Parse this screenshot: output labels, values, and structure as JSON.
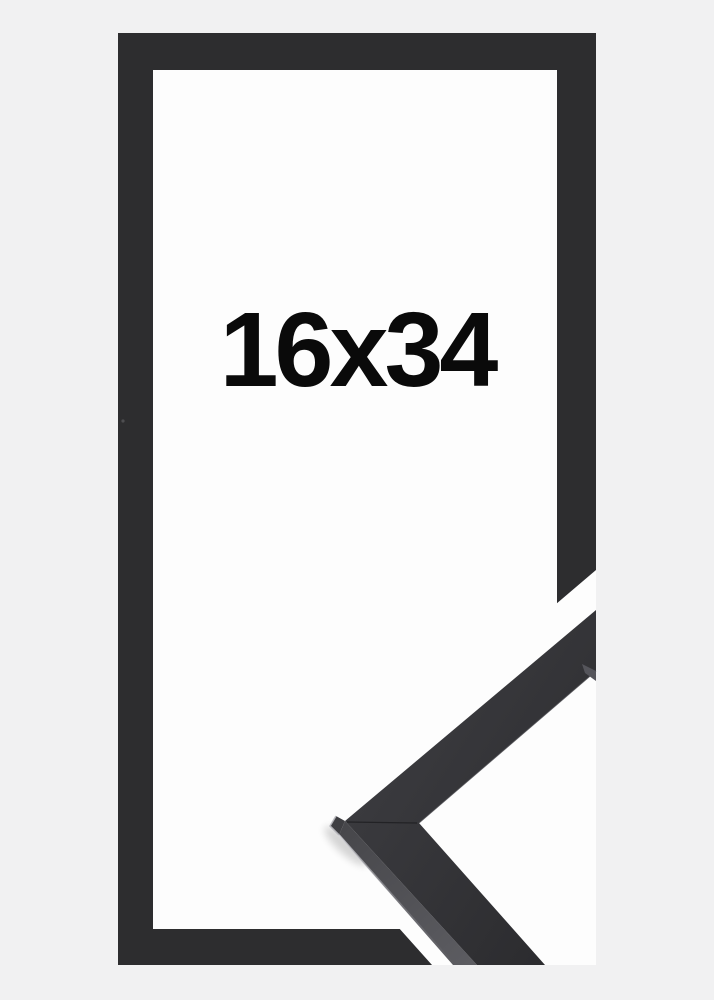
{
  "product": {
    "size_label": "16x34"
  },
  "colors": {
    "background": "#f1f1f2",
    "frame": "#2d2d2f",
    "interior_white": "#fdfdfd",
    "halo_white": "#fdfdfd",
    "label_text": "#0a0a0a",
    "moulding_top_light": "#38383c",
    "moulding_top_dark": "#2b2b2e",
    "moulding_side": "#515156",
    "moulding_end_face": "#55555b",
    "seam": "#1d1d20",
    "bevel_highlight": "#c4c4ca"
  }
}
